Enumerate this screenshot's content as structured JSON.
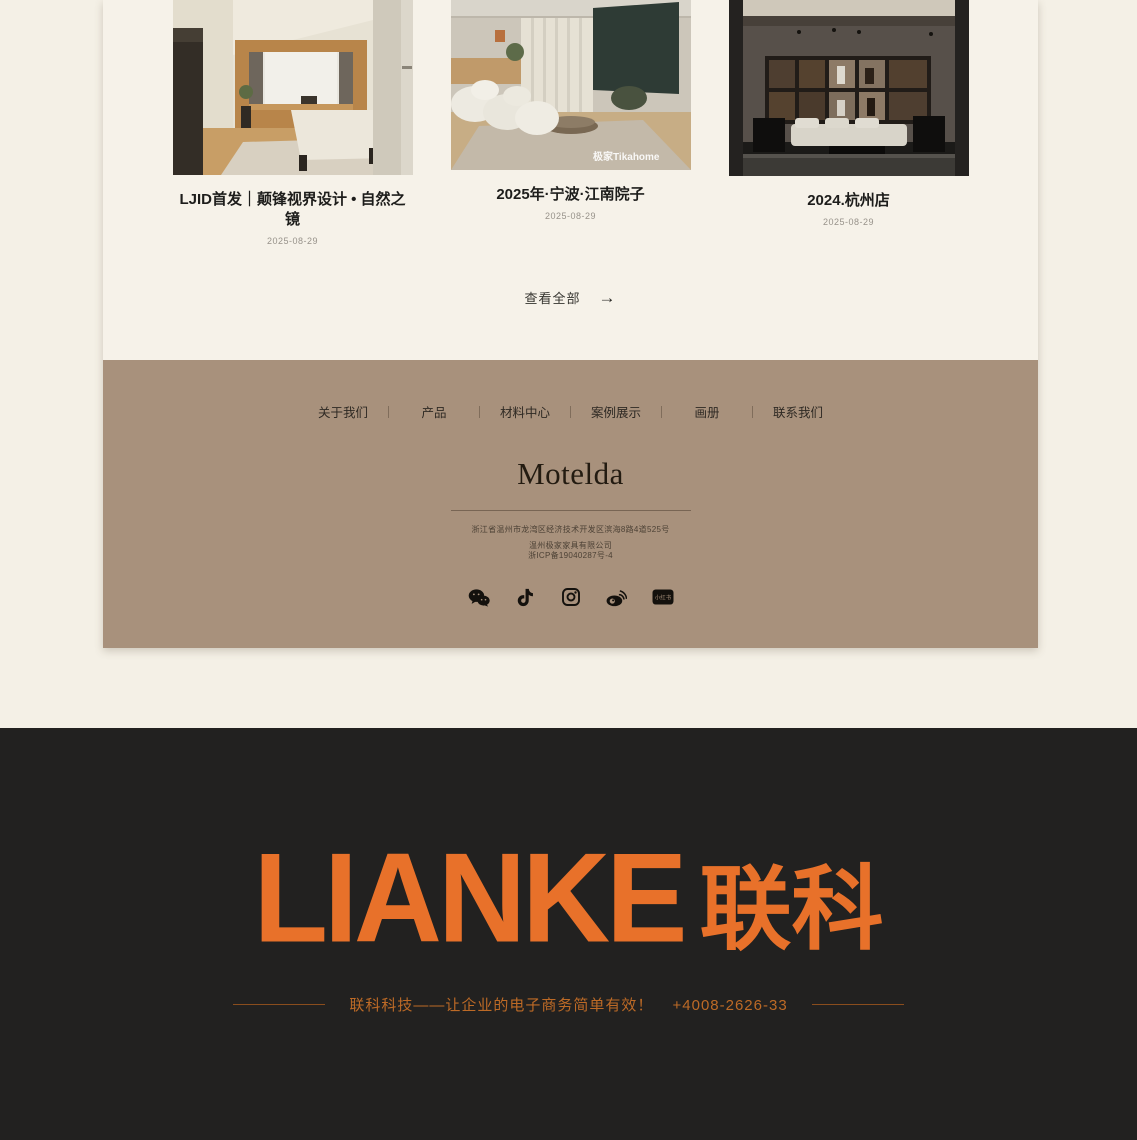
{
  "theme": {
    "page_bg": "#f4f0e6",
    "panel_bg": "#f6f2e9",
    "footer_bg": "#a8917c",
    "dark_bg": "#222120",
    "accent_orange": "#e8712a",
    "tagline_orange": "#bd6a26"
  },
  "cases_section": {
    "items": [
      {
        "title": "LJID首发｜颠锋视界设计 • 自然之镜",
        "date": "2025-08-29",
        "image": "bedroom-interior-photo"
      },
      {
        "title": "2025年·宁波·江南院子",
        "date": "2025-08-29",
        "image": "living-room-interior-photo",
        "watermark": "极家Tikahome"
      },
      {
        "title": "2024.杭州店",
        "date": "2025-08-29",
        "image": "dark-showroom-photo"
      }
    ],
    "view_all_label": "查看全部",
    "view_all_arrow": "→"
  },
  "footer": {
    "nav_items": [
      {
        "label": "关于我们"
      },
      {
        "label": "产品"
      },
      {
        "label": "材料中心"
      },
      {
        "label": "案例展示"
      },
      {
        "label": "画册"
      },
      {
        "label": "联系我们"
      }
    ],
    "logo": "Motelda",
    "address": "浙江省温州市龙湾区经济技术开发区滨海8路4道525号",
    "company": "温州极家家具有限公司",
    "icp": "浙ICP备19040287号-4",
    "social_icons": [
      "wechat-icon",
      "tiktok-icon",
      "instagram-icon",
      "weibo-icon",
      "xiaohongshu-icon"
    ],
    "xiaohongshu_text": "小红书"
  },
  "promo": {
    "logo_latin": "LIANKE",
    "logo_cn": "联科",
    "tagline": "联科科技——让企业的电子商务简单有效！",
    "phone": "+4008-2626-33"
  }
}
